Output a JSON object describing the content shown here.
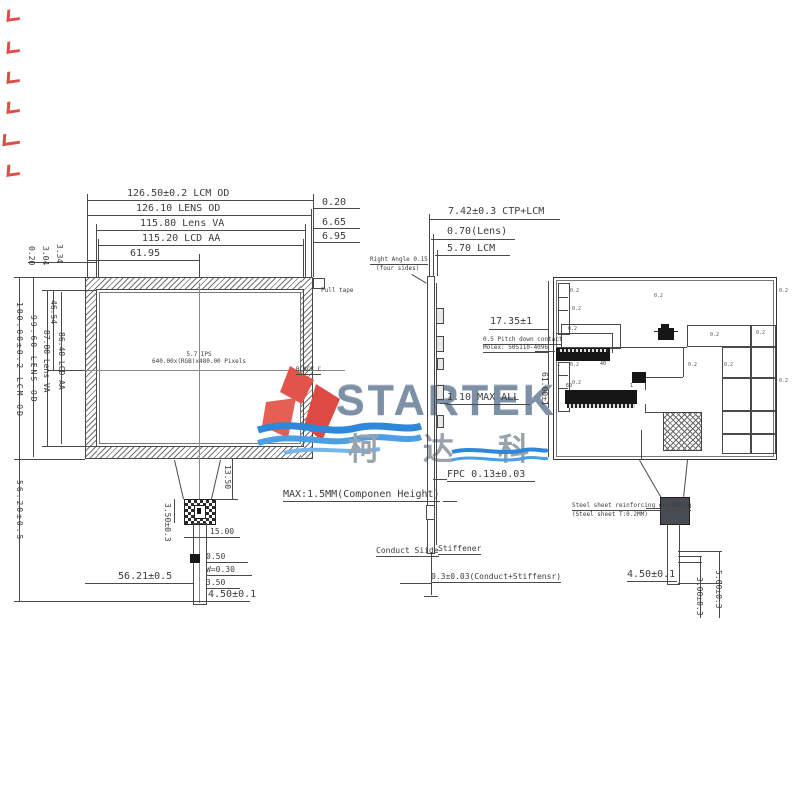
{
  "front": {
    "top_dims": [
      "126.50±0.2 LCM OD",
      "126.10 LENS OD",
      "115.80 Lens VA",
      "115.20 LCD AA",
      "61.95"
    ],
    "right_gaps": [
      "0.20",
      "6.65",
      "6.95"
    ],
    "left_gaps": [
      "0.20",
      "3.04",
      "3.34"
    ],
    "left_dims": [
      "100.00±0.2 LCM OD",
      "99.60 LENS OD",
      "87.00 Lens VA",
      "86.40 LCD AA",
      "46.54",
      "56.20±0.5"
    ],
    "screen_line1": "5.7 IPS",
    "screen_line2": "640.00x(RGB)x480.00 Pixels",
    "pull_tape": "Pull tape",
    "black_mark": "BLACK C",
    "fpc_dims": [
      "13.50",
      "15.00",
      "3.50±0.3",
      "0.50",
      "W=0.30",
      "3.50",
      "56.21±0.5",
      "4.50±0.1"
    ]
  },
  "side": {
    "top_dims": [
      "7.42±0.3 CTP+LCM",
      "0.70(Lens)",
      "5.70 LCM"
    ],
    "right_angle_1": "Right Angle 0.15",
    "right_angle_2": "(four sides)",
    "max_all": "1.10 MAX ALL",
    "fpc": "FPC 0.13±0.03",
    "comp_height": "MAX:1.5MM(Componen Height)",
    "conduct_side": "Conduct Siide",
    "stiffener": "Stiffener",
    "conduct_stiffener": "0.3±0.03(Conduct+Stiffensr)"
  },
  "back": {
    "d_width": "17.35±1",
    "molex_1": "0.5 Pitch down contact",
    "molex_2": "Molex: 505110-4096",
    "d_height": "61.00±1",
    "pin_a_start": "1",
    "pin_a_end": "40",
    "pin_b_start": "60",
    "pin_b_end": "1",
    "steel_1": "Steel sheet reinforcing grounding",
    "steel_2": "(Steel sheet T:0.2MM)",
    "tail_dims": [
      "4.50±0.1",
      "3.00±0.3",
      "5.00±0.3"
    ],
    "callout": "0.2"
  },
  "logo": {
    "brand": "STARTEK",
    "brand_cn": "柯达科"
  },
  "colors": {
    "line": "#4a4a4a",
    "red": "#d63c33",
    "blue": "#2f87d9",
    "brand": "#7e90a5"
  }
}
